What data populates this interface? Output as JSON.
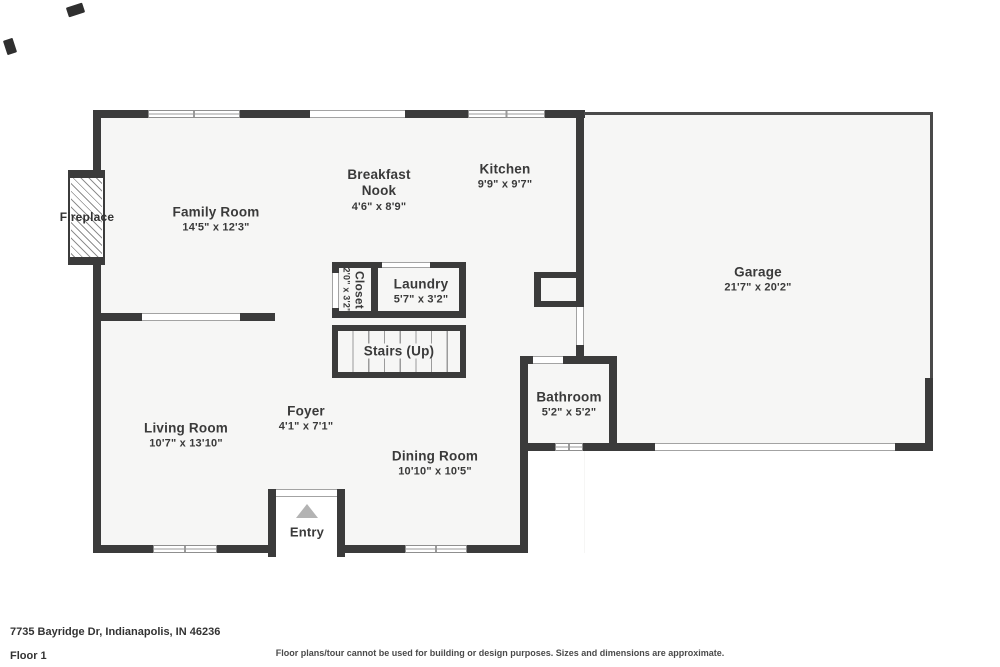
{
  "address": "7735 Bayridge Dr, Indianapolis, IN 46236",
  "floor_label": "Floor 1",
  "disclaimer": "Floor plans/tour cannot be used for building or design purposes. Sizes and dimensions are approximate.",
  "rooms": {
    "family_room": {
      "name": "Family Room",
      "dims": "14'5\" x 12'3\""
    },
    "breakfast_nook": {
      "name": "Breakfast Nook",
      "dims": "4'6\" x 8'9\""
    },
    "kitchen": {
      "name": "Kitchen",
      "dims": "9'9\" x 9'7\""
    },
    "garage": {
      "name": "Garage",
      "dims": "21'7\" x 20'2\""
    },
    "laundry": {
      "name": "Laundry",
      "dims": "5'7\" x 3'2\""
    },
    "closet": {
      "name": "Closet",
      "dims": "2'0\" x 3'2\""
    },
    "living_room": {
      "name": "Living Room",
      "dims": "10'7\" x 13'10\""
    },
    "foyer": {
      "name": "Foyer",
      "dims": "4'1\" x 7'1\""
    },
    "dining_room": {
      "name": "Dining Room",
      "dims": "10'10\" x 10'5\""
    },
    "bathroom": {
      "name": "Bathroom",
      "dims": "5'2\" x 5'2\""
    }
  },
  "features": {
    "stairs": "Stairs (Up)",
    "entry": "Entry",
    "fireplace": "Fireplace"
  },
  "colors": {
    "wall": "#3b3b3b",
    "floor": "#f6f6f5",
    "background": "#ffffff",
    "text": "#3a3a3a",
    "entry_arrow": "#b3b3b3"
  }
}
